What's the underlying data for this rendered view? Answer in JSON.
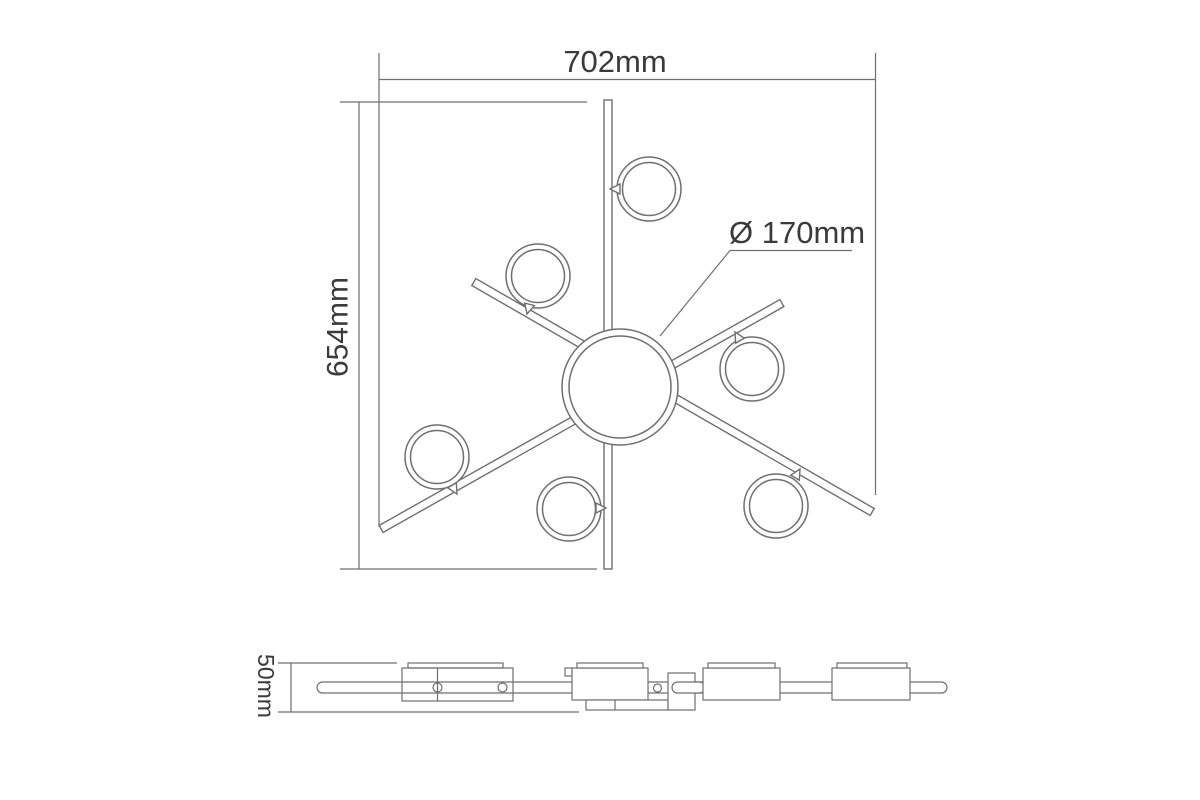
{
  "drawing": {
    "background_color": "#ffffff",
    "line_color": "#6f6f6f",
    "text_color": "#3a3a3a",
    "top_view": {
      "width_label": "702mm",
      "height_label": "654mm",
      "disc_diameter_label": "Ø 170mm",
      "ring_count": 6
    },
    "side_view": {
      "height_label": "50mm"
    }
  }
}
